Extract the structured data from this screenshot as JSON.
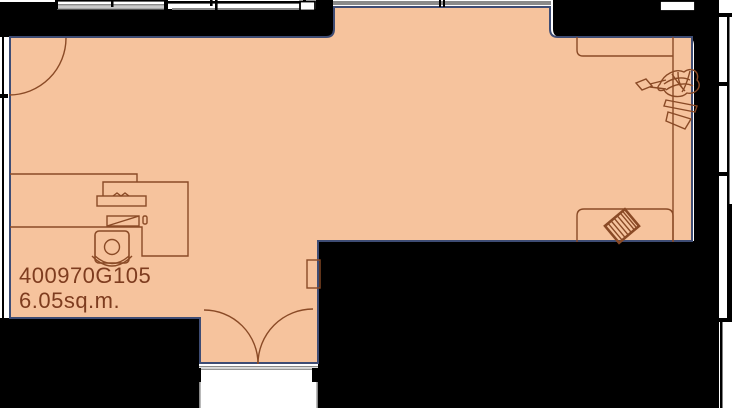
{
  "floorplan": {
    "room": {
      "id": "400970G105",
      "area": "6.05sq.m."
    },
    "colors": {
      "background": "#ffffff",
      "wall": "#000000",
      "room_fill": "#f6c39d",
      "room_outline": "#3e4c74",
      "furniture_line": "#8a4a26",
      "label_text": "#7e3c1f",
      "window_dark": "#8a8a8a",
      "window_light": "#c9c9c9"
    }
  }
}
